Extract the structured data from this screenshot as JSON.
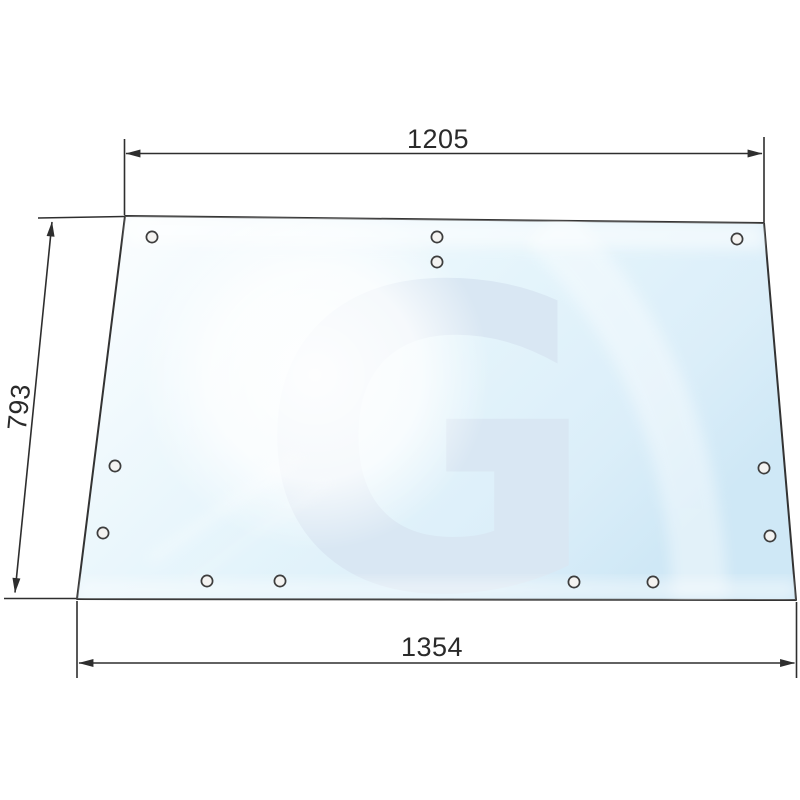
{
  "diagram": {
    "title": "glass-panel-technical-drawing",
    "dimensions": {
      "top": "1205",
      "side": "793",
      "bottom": "1354"
    },
    "watermark_letter": "G",
    "hole_count": "12",
    "colors": {
      "line": "#2e2e2e",
      "glass_highlight": "#ffffff",
      "glass_light": "#f0f9fd",
      "glass_mid": "#e4f4fb",
      "glass_deep": "#cfe8f6",
      "watermark": "#d9e7f3",
      "hole_fill": "#f4f3f1"
    }
  }
}
